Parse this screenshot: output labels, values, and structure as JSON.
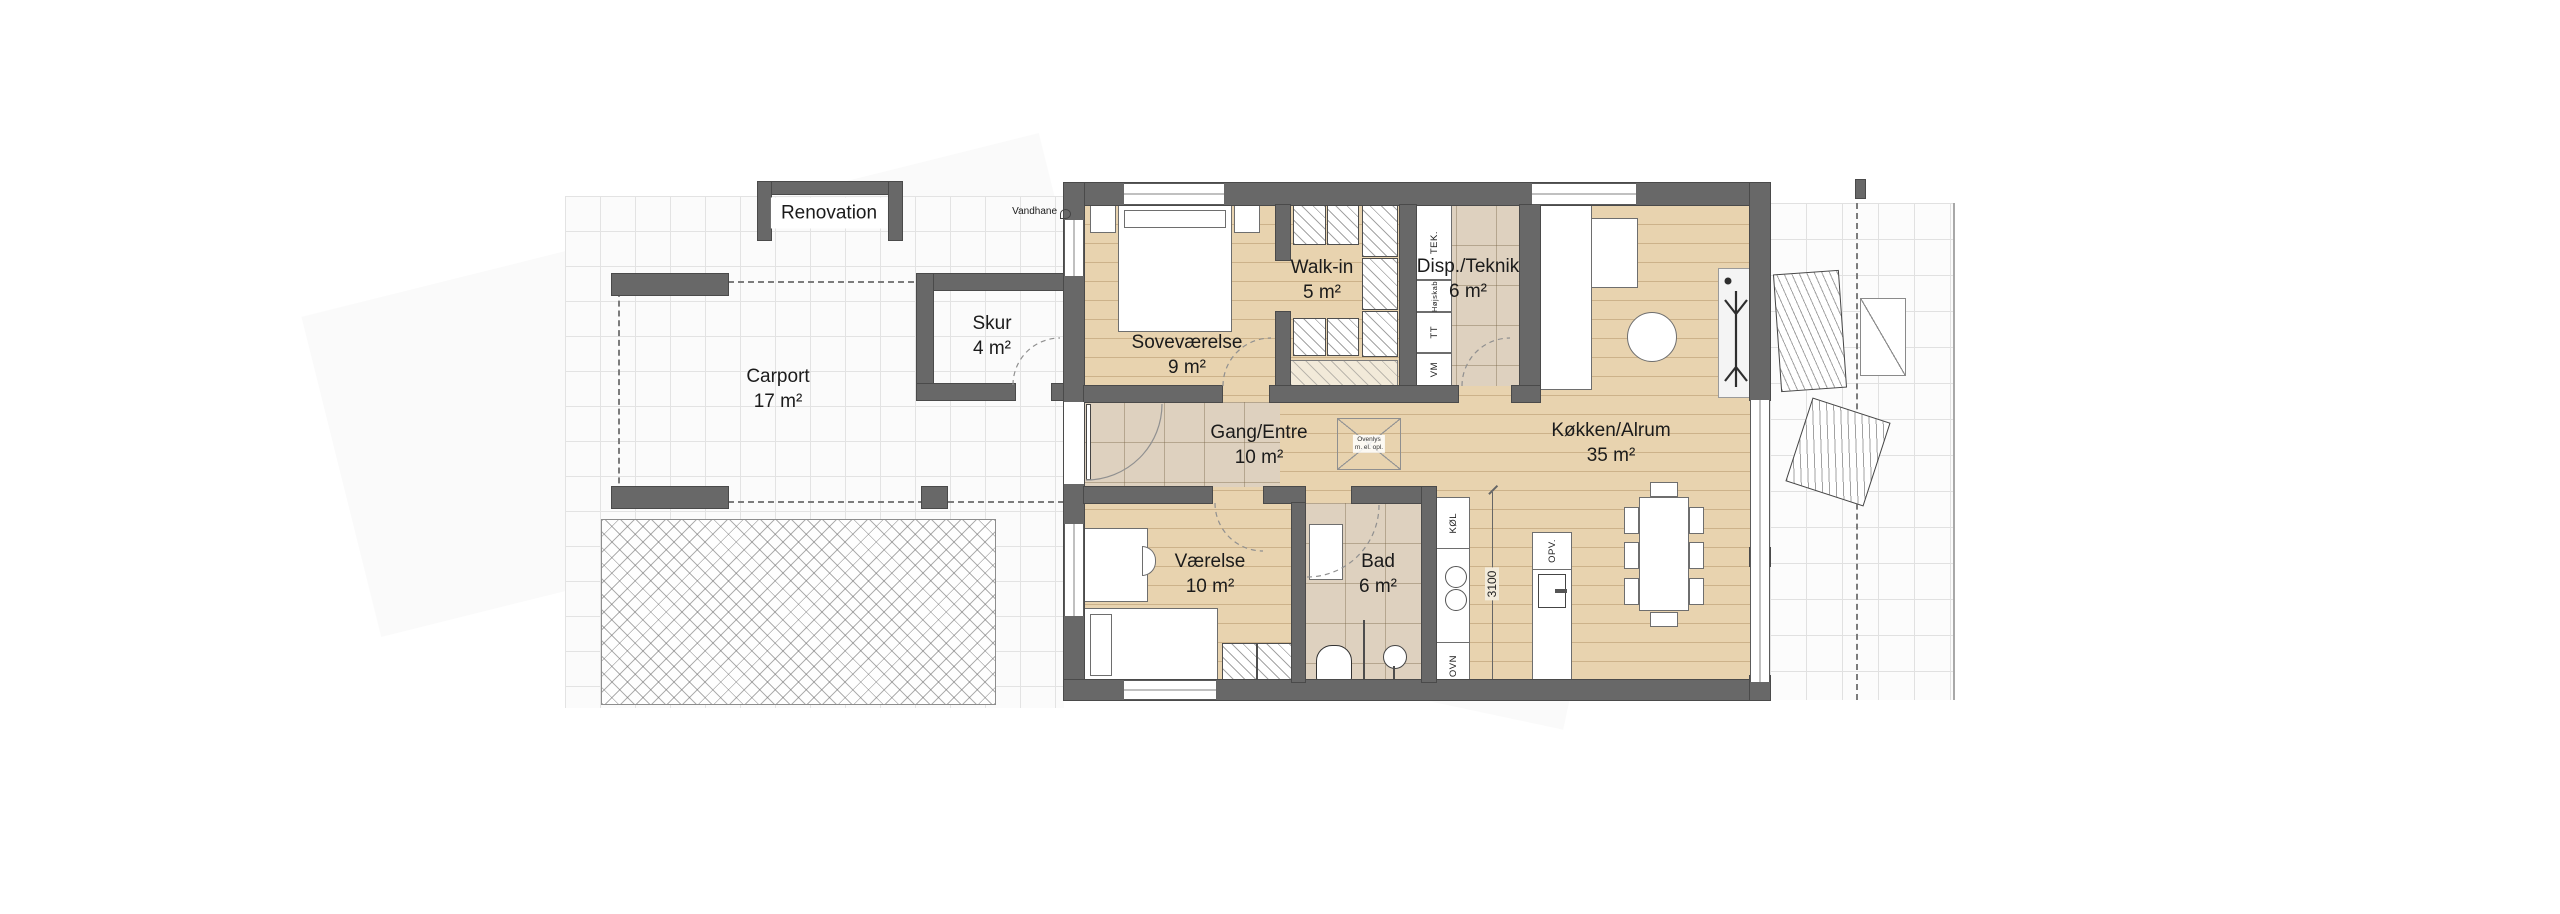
{
  "title": "Floor plan",
  "rooms": {
    "renovation": {
      "name": "Renovation"
    },
    "skur": {
      "name": "Skur",
      "area": "4 m²"
    },
    "carport": {
      "name": "Carport",
      "area": "17 m²"
    },
    "sovevaerelse": {
      "name": "Soveværelse",
      "area": "9 m²"
    },
    "walkin": {
      "name": "Walk-in",
      "area": "5 m²"
    },
    "disp": {
      "name": "Disp./Teknik",
      "area": "6 m²"
    },
    "gang": {
      "name": "Gang/Entre",
      "area": "10 m²"
    },
    "koekken": {
      "name": "Køkken/Alrum",
      "area": "35 m²"
    },
    "vaerelse": {
      "name": "Værelse",
      "area": "10 m²"
    },
    "bad": {
      "name": "Bad",
      "area": "6 m²"
    }
  },
  "ann": {
    "vandhane": "Vandhane",
    "ovenlys1": "Ovenlys",
    "ovenlys2": "m. el. opl.",
    "dim": "3100"
  },
  "app": {
    "tek": "TEK.",
    "hojskab": "Højskab",
    "tt": "TT",
    "vm": "VM",
    "kol": "KØL",
    "ovn": "OVN",
    "opv": "OPV."
  },
  "colors": {
    "wall": "#686868",
    "wood_floor": "#e8d3af",
    "tile_floor": "#ded1bf"
  }
}
